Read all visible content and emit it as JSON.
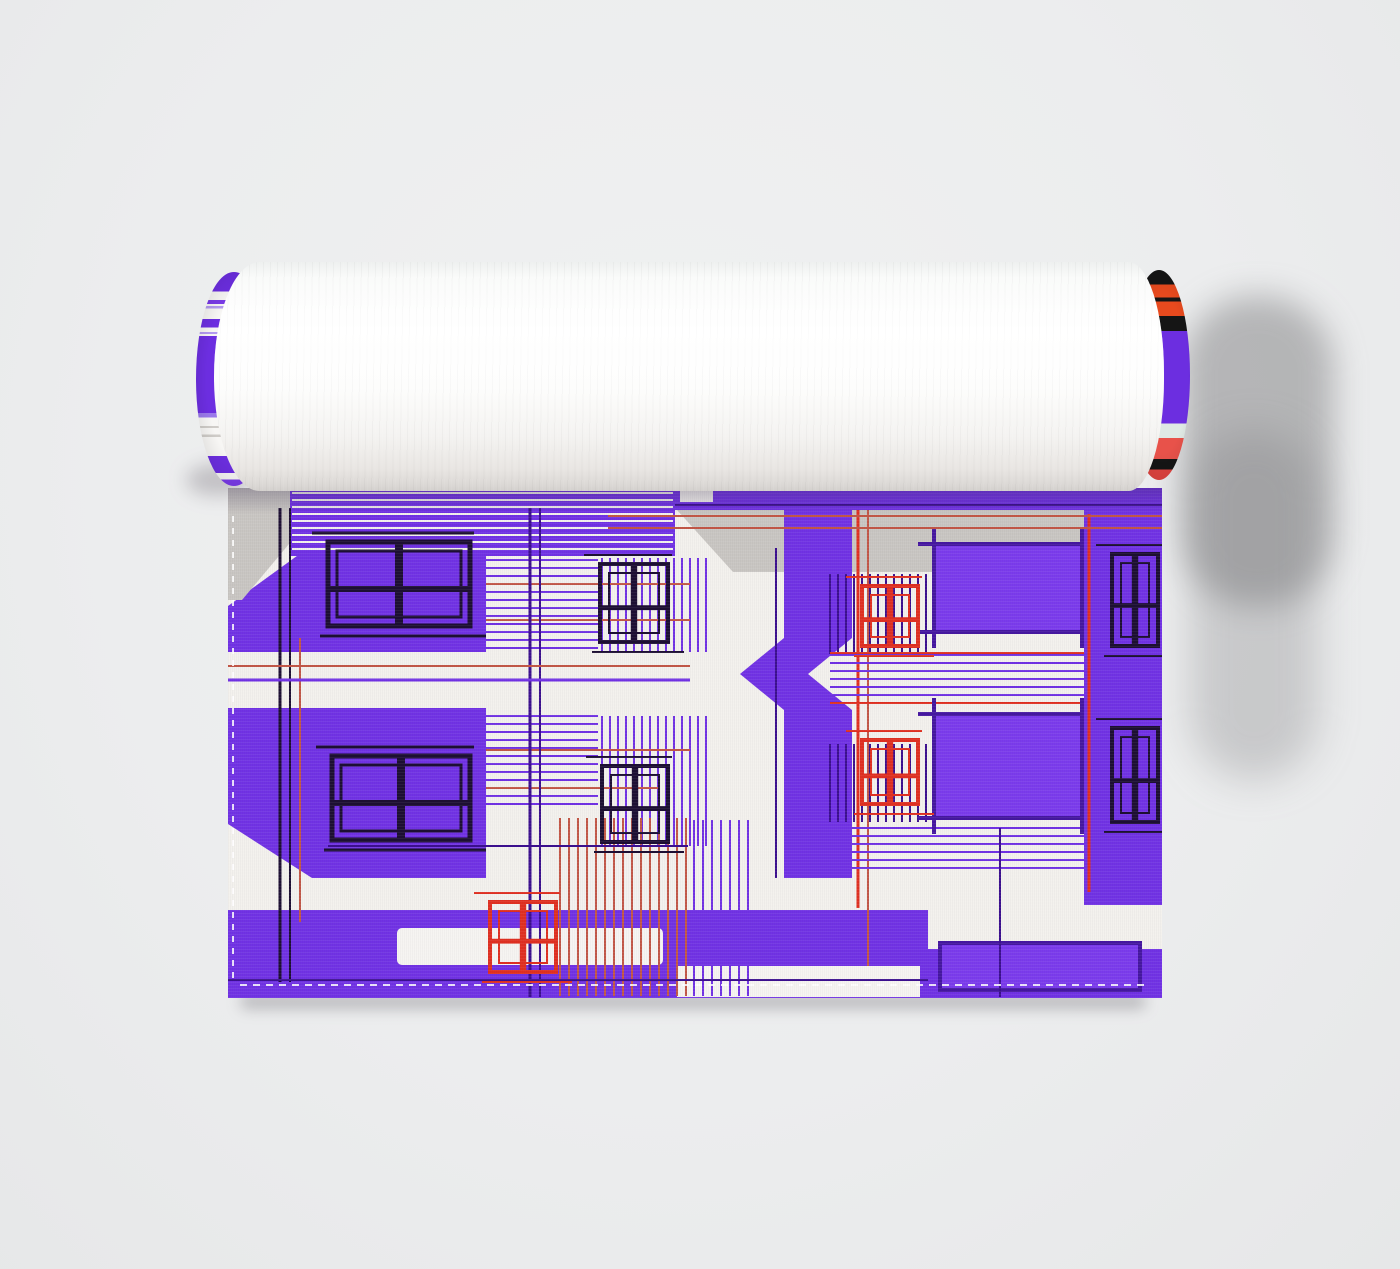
{
  "scene": {
    "background_color": "#ecedee",
    "object": "rolled-fabric-with-architectural-print"
  },
  "roll": {
    "body_color": "#fcfcfb",
    "left_cap_stripes": [
      {
        "c": "#6c2ee0",
        "h": 9
      },
      {
        "c": "#f7f6f4",
        "h": 4
      },
      {
        "c": "#7a3be8",
        "h": 2
      },
      {
        "c": "#f7f6f4",
        "h": 1
      },
      {
        "c": "#b39af0",
        "h": 1
      },
      {
        "c": "#f7f6f4",
        "h": 5
      },
      {
        "c": "#6c2ee0",
        "h": 4
      },
      {
        "c": "#f7f6f4",
        "h": 2
      },
      {
        "c": "#b39af0",
        "h": 1
      },
      {
        "c": "#f7f6f4",
        "h": 1
      },
      {
        "c": "#6c2ee0",
        "h": 36
      },
      {
        "c": "#9a79ea",
        "h": 2
      },
      {
        "c": "#f7f6f4",
        "h": 4
      },
      {
        "c": "#cfccc8",
        "h": 1
      },
      {
        "c": "#f7f6f4",
        "h": 3
      },
      {
        "c": "#cfccc8",
        "h": 1
      },
      {
        "c": "#f7f6f4",
        "h": 9
      },
      {
        "c": "#6c2ee0",
        "h": 8
      },
      {
        "c": "#f7f6f4",
        "h": 3
      },
      {
        "c": "#7a3be8",
        "h": 3
      }
    ],
    "right_cap_stripes": [
      {
        "c": "#151515",
        "h": 7
      },
      {
        "c": "#e84a1e",
        "h": 6
      },
      {
        "c": "#151515",
        "h": 2
      },
      {
        "c": "#e84a1e",
        "h": 7
      },
      {
        "c": "#151515",
        "h": 7
      },
      {
        "c": "#6c2ee0",
        "h": 44
      },
      {
        "c": "#dfe9e4",
        "h": 7
      },
      {
        "c": "#e8524a",
        "h": 10
      },
      {
        "c": "#151515",
        "h": 5
      },
      {
        "c": "#df4440",
        "h": 5
      }
    ]
  },
  "towel": {
    "pattern": {
      "viewbox": "0 0 934 510",
      "palette": {
        "purple": "#7132e4",
        "deep": "#3b0f8e",
        "lav": "#a583ee",
        "red": "#e03021",
        "red2": "#c25747",
        "black": "#1d0f33",
        "white": "#f3f1ed",
        "gray": "#c9c6c2",
        "hem": "#f6f4f1",
        "frameFill": "#7b3bec",
        "frameStroke": "#4517a0",
        "stitch": "rgba(255,255,255,0.85)"
      },
      "layers": [
        {
          "t": "rect",
          "x": 0,
          "y": 0,
          "w": 934,
          "h": 510,
          "c": "white"
        },
        {
          "t": "poly",
          "pts": "0,118 135,20 258,20 258,164 0,164",
          "c": "purple"
        },
        {
          "t": "poly",
          "pts": "0,0 108,0 14,112 0,112",
          "c": "gray"
        },
        {
          "t": "rect",
          "x": 62,
          "y": 0,
          "w": 385,
          "h": 68,
          "c": "purple"
        },
        {
          "t": "hatch",
          "x": 64,
          "y": 5,
          "w": 381,
          "h": 61,
          "dir": "h",
          "gap": 7,
          "c": "white",
          "lw": 2
        },
        {
          "t": "rect",
          "x": 447,
          "y": 0,
          "w": 487,
          "h": 22,
          "c": "purple"
        },
        {
          "t": "line",
          "x1": 447,
          "y1": 17,
          "x2": 934,
          "y2": 17,
          "c": "deep",
          "lw": 2
        },
        {
          "t": "rect",
          "x": 452,
          "y": 0,
          "w": 33,
          "h": 14,
          "c": "white"
        },
        {
          "t": "poly",
          "pts": "449,22 934,22 934,84 505,84",
          "c": "gray"
        },
        {
          "t": "rect",
          "x": 0,
          "y": 164,
          "w": 462,
          "h": 56,
          "c": "white"
        },
        {
          "t": "rect",
          "x": 0,
          "y": 220,
          "w": 258,
          "h": 170,
          "c": "purple"
        },
        {
          "t": "poly",
          "pts": "0,336 84,390 0,390",
          "c": "white"
        },
        {
          "t": "rect",
          "x": 0,
          "y": 390,
          "w": 462,
          "h": 32,
          "c": "white"
        },
        {
          "t": "rect",
          "x": 0,
          "y": 422,
          "w": 934,
          "h": 88,
          "c": "purple"
        },
        {
          "t": "hatch",
          "x": 258,
          "y": 72,
          "w": 112,
          "h": 90,
          "dir": "h",
          "gap": 8,
          "c": "purple",
          "lw": 2
        },
        {
          "t": "hatch",
          "x": 374,
          "y": 70,
          "w": 108,
          "h": 94,
          "dir": "v",
          "gap": 8,
          "c": "purple",
          "lw": 2
        },
        {
          "t": "hatch",
          "x": 258,
          "y": 228,
          "w": 112,
          "h": 94,
          "dir": "h",
          "gap": 8,
          "c": "purple",
          "lw": 2
        },
        {
          "t": "hatch",
          "x": 374,
          "y": 228,
          "w": 108,
          "h": 130,
          "dir": "v",
          "gap": 8,
          "c": "purple",
          "lw": 2
        },
        {
          "t": "line",
          "x1": 258,
          "y1": 96,
          "x2": 462,
          "y2": 96,
          "c": "red2",
          "lw": 2
        },
        {
          "t": "line",
          "x1": 258,
          "y1": 132,
          "x2": 462,
          "y2": 132,
          "c": "red2",
          "lw": 2
        },
        {
          "t": "line",
          "x1": 258,
          "y1": 262,
          "x2": 462,
          "y2": 262,
          "c": "red2",
          "lw": 2
        },
        {
          "t": "line",
          "x1": 258,
          "y1": 300,
          "x2": 430,
          "y2": 300,
          "c": "red2",
          "lw": 2
        },
        {
          "t": "rect",
          "x": 556,
          "y": 22,
          "w": 68,
          "h": 368,
          "c": "purple"
        },
        {
          "t": "poly",
          "pts": "556,150 512,186 556,222",
          "c": "purple"
        },
        {
          "t": "poly",
          "pts": "624,150 580,186 624,222",
          "c": "white"
        },
        {
          "t": "line",
          "x1": 630,
          "y1": 22,
          "x2": 630,
          "y2": 420,
          "c": "red",
          "lw": 3
        },
        {
          "t": "line",
          "x1": 640,
          "y1": 22,
          "x2": 640,
          "y2": 509,
          "c": "red2",
          "lw": 2
        },
        {
          "t": "line",
          "x1": 548,
          "y1": 60,
          "x2": 548,
          "y2": 390,
          "c": "deep",
          "lw": 2
        },
        {
          "t": "hatch",
          "x": 602,
          "y": 86,
          "w": 100,
          "h": 80,
          "dir": "v",
          "gap": 8,
          "c": "deep",
          "lw": 2
        },
        {
          "t": "hatch",
          "x": 602,
          "y": 256,
          "w": 100,
          "h": 78,
          "dir": "v",
          "gap": 8,
          "c": "deep",
          "lw": 2
        },
        {
          "t": "hatch",
          "x": 602,
          "y": 167,
          "w": 332,
          "h": 46,
          "dir": "h",
          "gap": 8,
          "c": "purple",
          "lw": 2
        },
        {
          "t": "hatch",
          "x": 602,
          "y": 340,
          "w": 332,
          "h": 42,
          "dir": "h",
          "gap": 8,
          "c": "purple",
          "lw": 2
        },
        {
          "t": "line",
          "x1": 602,
          "y1": 165,
          "x2": 900,
          "y2": 165,
          "c": "red",
          "lw": 2
        },
        {
          "t": "line",
          "x1": 602,
          "y1": 215,
          "x2": 860,
          "y2": 215,
          "c": "red",
          "lw": 2
        },
        {
          "t": "frame",
          "x": 706,
          "y": 56,
          "w": 148,
          "h": 88,
          "ticks": true
        },
        {
          "t": "frame",
          "x": 706,
          "y": 226,
          "w": 148,
          "h": 104,
          "ticks": true
        },
        {
          "t": "rect",
          "x": 856,
          "y": 22,
          "w": 78,
          "h": 400,
          "c": "purple"
        },
        {
          "t": "line",
          "x1": 861,
          "y1": 26,
          "x2": 861,
          "y2": 404,
          "c": "red",
          "lw": 3
        },
        {
          "t": "rect",
          "x": 169,
          "y": 440,
          "w": 266,
          "h": 37,
          "c": "hem",
          "rx": 5
        },
        {
          "t": "rect",
          "x": 449,
          "y": 478,
          "w": 243,
          "h": 31,
          "c": "hem"
        },
        {
          "t": "rect",
          "x": 700,
          "y": 417,
          "w": 234,
          "h": 44,
          "c": "white"
        },
        {
          "t": "frame",
          "x": 712,
          "y": 455,
          "w": 200,
          "h": 47,
          "ticks": false
        },
        {
          "t": "hatch",
          "x": 332,
          "y": 330,
          "w": 126,
          "h": 178,
          "dir": "v",
          "gap": 9,
          "c": "red2",
          "lw": 2
        },
        {
          "t": "hatch",
          "x": 466,
          "y": 332,
          "w": 56,
          "h": 176,
          "dir": "v",
          "gap": 9,
          "c": "purple",
          "lw": 2
        },
        {
          "t": "line",
          "x1": 52,
          "y1": 20,
          "x2": 52,
          "y2": 494,
          "c": "black",
          "lw": 3
        },
        {
          "t": "line",
          "x1": 62,
          "y1": 20,
          "x2": 62,
          "y2": 494,
          "c": "black",
          "lw": 2
        },
        {
          "t": "line",
          "x1": 72,
          "y1": 150,
          "x2": 72,
          "y2": 434,
          "c": "red2",
          "lw": 2
        },
        {
          "t": "line",
          "x1": 302,
          "y1": 20,
          "x2": 302,
          "y2": 509,
          "c": "deep",
          "lw": 3
        },
        {
          "t": "line",
          "x1": 312,
          "y1": 20,
          "x2": 312,
          "y2": 509,
          "c": "deep",
          "lw": 2
        },
        {
          "t": "line",
          "x1": 0,
          "y1": 178,
          "x2": 462,
          "y2": 178,
          "c": "red2",
          "lw": 2
        },
        {
          "t": "line",
          "x1": 0,
          "y1": 192,
          "x2": 462,
          "y2": 192,
          "c": "purple",
          "lw": 3
        },
        {
          "t": "line",
          "x1": 380,
          "y1": 28,
          "x2": 934,
          "y2": 28,
          "c": "red2",
          "lw": 2
        },
        {
          "t": "line",
          "x1": 380,
          "y1": 40,
          "x2": 934,
          "y2": 40,
          "c": "red2",
          "lw": 2
        },
        {
          "t": "line",
          "x1": 0,
          "y1": 492,
          "x2": 700,
          "y2": 492,
          "c": "deep",
          "lw": 2
        },
        {
          "t": "line",
          "x1": 100,
          "y1": 358,
          "x2": 460,
          "y2": 358,
          "c": "deep",
          "lw": 2
        },
        {
          "t": "line",
          "x1": 772,
          "y1": 340,
          "x2": 772,
          "y2": 509,
          "c": "deep",
          "lw": 2
        },
        {
          "t": "window",
          "x": 100,
          "y": 54,
          "w": 142,
          "h": 84,
          "c": "black",
          "lw": 5
        },
        {
          "t": "window",
          "x": 104,
          "y": 268,
          "w": 138,
          "h": 84,
          "c": "black",
          "lw": 5
        },
        {
          "t": "window",
          "x": 372,
          "y": 76,
          "w": 68,
          "h": 78,
          "c": "black",
          "lw": 4
        },
        {
          "t": "window",
          "x": 374,
          "y": 278,
          "w": 66,
          "h": 76,
          "c": "black",
          "lw": 4
        },
        {
          "t": "window",
          "x": 884,
          "y": 66,
          "w": 46,
          "h": 92,
          "c": "black",
          "lw": 4
        },
        {
          "t": "window",
          "x": 884,
          "y": 240,
          "w": 46,
          "h": 94,
          "c": "black",
          "lw": 4
        },
        {
          "t": "window",
          "x": 634,
          "y": 98,
          "w": 56,
          "h": 60,
          "c": "red",
          "lw": 4
        },
        {
          "t": "window",
          "x": 634,
          "y": 252,
          "w": 56,
          "h": 64,
          "c": "red",
          "lw": 4
        },
        {
          "t": "window",
          "x": 262,
          "y": 414,
          "w": 66,
          "h": 70,
          "c": "red",
          "lw": 4
        },
        {
          "t": "line",
          "x1": 12,
          "y1": 497,
          "x2": 922,
          "y2": 497,
          "c": "stitch",
          "lw": 2,
          "dash": "7 6"
        },
        {
          "t": "line",
          "x1": 5,
          "y1": 28,
          "x2": 5,
          "y2": 492,
          "c": "stitch",
          "lw": 2,
          "dash": "6 6"
        }
      ]
    }
  }
}
